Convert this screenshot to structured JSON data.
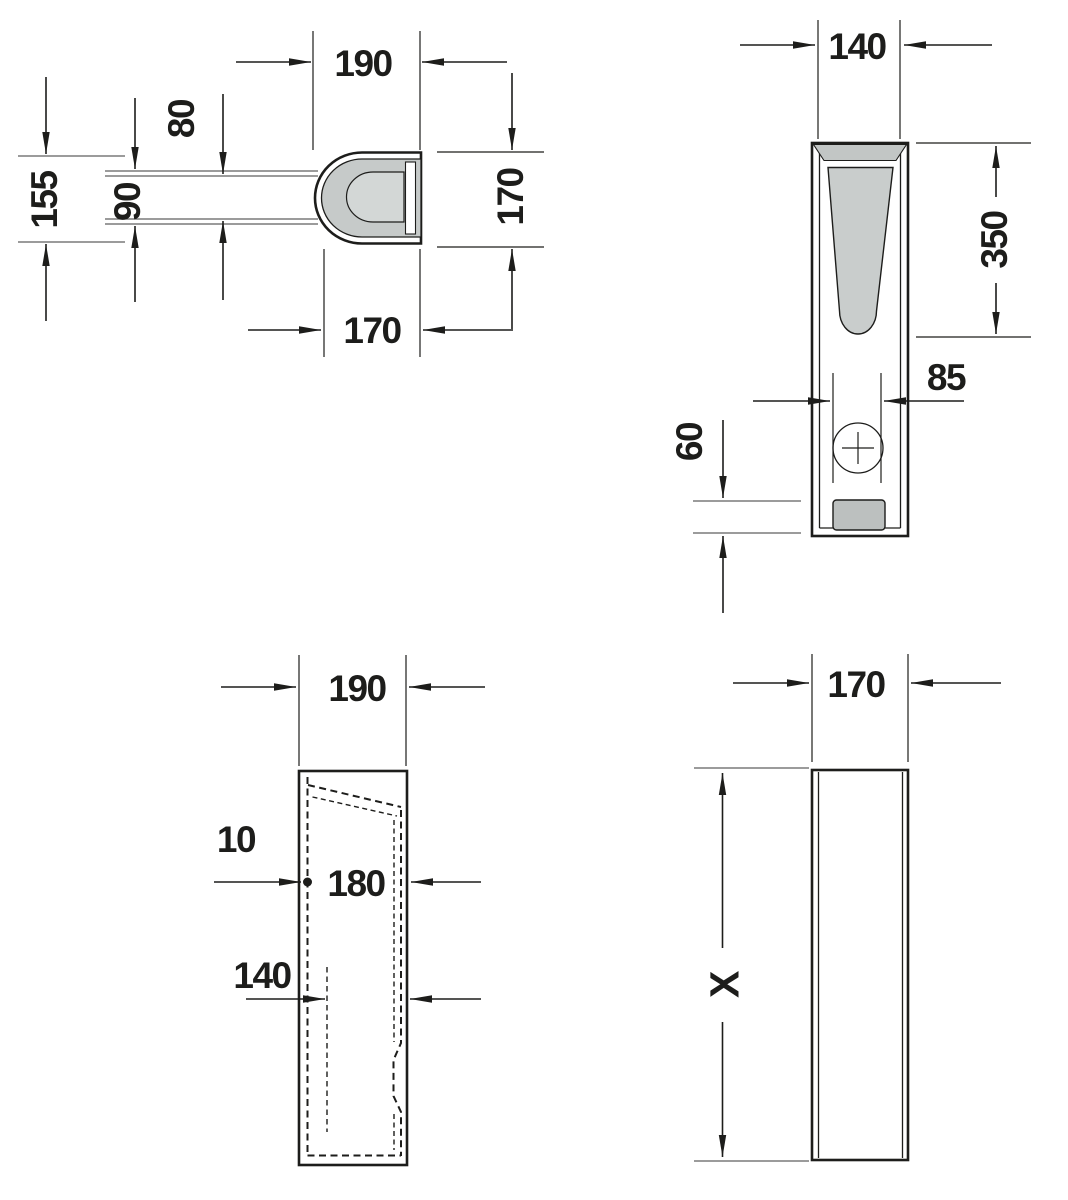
{
  "drawing": {
    "type": "technical-dimension-drawing",
    "views": {
      "plan": {
        "width": "190",
        "inner_depth": "80",
        "outer_depth": "90",
        "height": "155",
        "side_height": "170",
        "bottom_width": "170"
      },
      "front": {
        "width": "140",
        "channel_length": "350",
        "hole_spacing": "85",
        "outlet_height": "60"
      },
      "side": {
        "width": "190",
        "wall_offset": "10",
        "inner_width": "180",
        "rib_offset": "140"
      },
      "back": {
        "width": "170",
        "height": "X"
      }
    },
    "colors": {
      "line": "#1d1d1b",
      "fill_mid_gray": "#c6cac9",
      "fill_light_gray": "#d3d7d6",
      "fill_band_gray": "#c2c6c5",
      "fill_channel_gray": "#c9cdcc",
      "fill_outlet_gray": "#bcc0bf",
      "background": "#ffffff"
    }
  }
}
